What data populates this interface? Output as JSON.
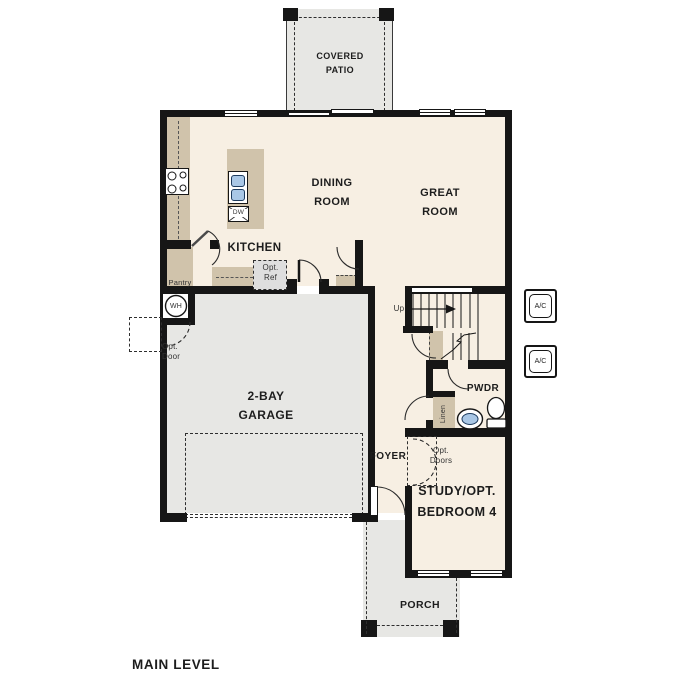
{
  "footer": {
    "title": "MAIN LEVEL"
  },
  "rooms": {
    "covered_patio": "COVERED\nPATIO",
    "dining_room": "DINING\nROOM",
    "great_room": "GREAT\nROOM",
    "kitchen": "KITCHEN",
    "garage": "2-BAY\nGARAGE",
    "powder": "PWDR",
    "foyer": "FOYER",
    "study": "STUDY/OPT.\nBEDROOM 4",
    "porch": "PORCH"
  },
  "annotations": {
    "pantry": "Pantry",
    "opt_ref": "Opt.\nRef",
    "opt_door": "Opt.\nDoor",
    "opt_doors": "Opt.\nDoors",
    "up": "Up",
    "water_heater": "WH",
    "dishwasher": "DW",
    "linen": "Linen",
    "ac_unit_top": "A/C",
    "ac_unit_bottom": "A/C"
  },
  "colors": {
    "floor": "#f7efe3",
    "concrete": "#e7e7e4",
    "cabinet": "#d0c3ab",
    "wall": "#161616",
    "fixture_blue": "#a9c7e6",
    "optional_fill": "#dedede"
  }
}
